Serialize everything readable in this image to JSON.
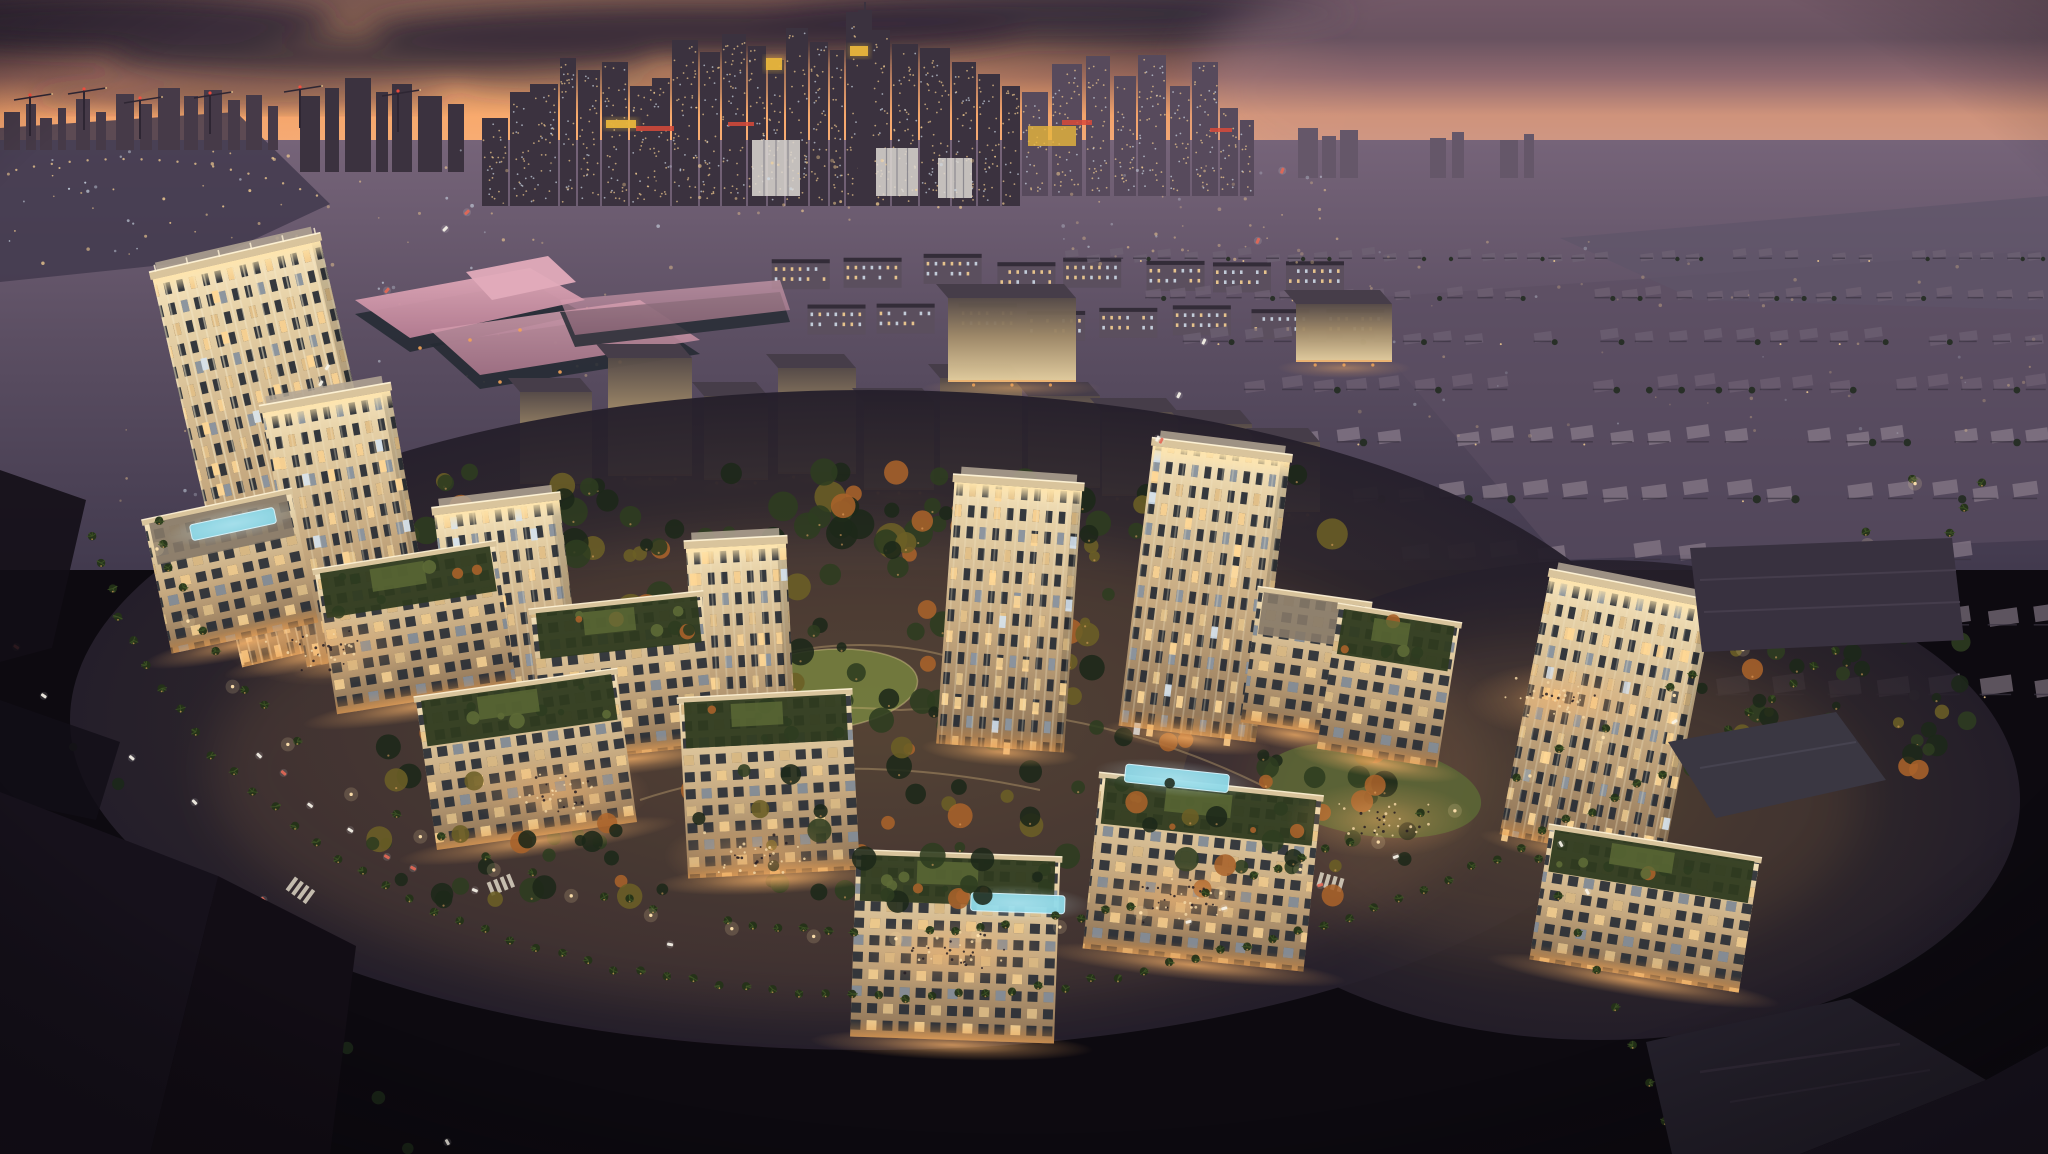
{
  "meta": {
    "description": "Aerial dusk rendering of a palm-lined residential master-planned community: cream mid-rise towers and podium blocks with lit crowns around a central park with lagoon and lawns, ring boulevard with traffic, floodlit campus buildings behind, villa suburbs right, and a high-rise downtown skyline silhouetted against an orange sunset.",
    "time_of_day": "dusk",
    "image_kind": "architectural-rendering"
  },
  "palette": {
    "sky_top": "#443344",
    "cloud_dark": "#342939",
    "sky_dusk": "#7b5254",
    "sky_orange": "#ef9e6a",
    "sky_salmon": "#efa87d",
    "sky_pink": "#d49a8b",
    "sky_lavender": "#aa8691",
    "haze_ground": "#766479",
    "sun_glow": "#ffb26f",
    "plain_mid": "#5c4f63",
    "plain_dark": "#423a4e",
    "sil_near": "#3b323f",
    "sil_mid": "#463a48",
    "sil_far": "#574a5c",
    "sil_haze": "#655769",
    "window_warm": "#ffd795",
    "window_cool": "#d5e2ee",
    "sign_red": "#d84a3a",
    "crown_yellow": "#e7b53c",
    "light_amber": "#f2a357",
    "plaza_glow": "#f7b168",
    "street_glow": "#e9953f",
    "facade_lit": "#f5e3bd",
    "facade_hi": "#e7d2a8",
    "facade_mid": "#c5a87f",
    "facade_shadow": "#8c7154",
    "pier_light": "#f2e5c4",
    "glass_dark": "#262b34",
    "roof_light": "#b3a694",
    "roof_mid": "#857867",
    "parapet": "#d9c49c",
    "crown_glow": "#ffe5ac",
    "campus_dark": "#564b47",
    "campus_mid": "#a08a68",
    "campus_lit": "#e9d3a2",
    "pink_roof": "#b97f95",
    "pink_roof_hi": "#e2abba",
    "pool_aqua": "#82d4e4",
    "pool_rim": "#d8f6ff",
    "pond": "#c5e2de",
    "lawn": "#77823f",
    "lawn_dim": "#5d6a36",
    "tree_dark": "#1c2819",
    "tree_mid": "#2d3c20",
    "tree_warm": "#6b5e26",
    "tree_autumn": "#a8622a",
    "palm": "#243318",
    "asphalt": "#181219",
    "road_warm": "#64452f",
    "ground_core": "#453930",
    "ground_edge": "#251f2b",
    "villa_roof": "#8b7e8c",
    "villa_far": "#6e6173",
    "fg_dark": "#120e16",
    "roof_dark": "#24202b",
    "car_white": "#f7f3e6",
    "car_red": "#e0543f",
    "water": "#5e5468"
  },
  "scene": {
    "skyline": {
      "clusters": [
        {
          "fill": "sil_mid",
          "bottom": 150,
          "bars": [
            [
              4,
              16,
              112
            ],
            [
              26,
              10,
              104
            ],
            [
              40,
              12,
              118
            ],
            [
              58,
              8,
              108
            ],
            [
              76,
              14,
              99
            ],
            [
              96,
              10,
              112
            ],
            [
              116,
              18,
              94
            ],
            [
              140,
              12,
              104
            ],
            [
              158,
              22,
              88
            ],
            [
              184,
              14,
              96
            ],
            [
              204,
              18,
              90
            ],
            [
              228,
              12,
              100
            ],
            [
              246,
              16,
              95
            ],
            [
              268,
              10,
              106
            ]
          ]
        },
        {
          "fill": "sil_near",
          "bottom": 172,
          "bars": [
            [
              300,
              20,
              96
            ],
            [
              325,
              14,
              88
            ],
            [
              345,
              26,
              78
            ],
            [
              376,
              12,
              92
            ],
            [
              392,
              20,
              84
            ],
            [
              418,
              24,
              96
            ],
            [
              448,
              16,
              104
            ]
          ]
        },
        {
          "fill": "sil_near",
          "bottom": 206,
          "windows": true,
          "bars": [
            [
              482,
              26,
              118
            ],
            [
              510,
              20,
              92
            ],
            [
              530,
              28,
              84
            ],
            [
              560,
              16,
              58
            ],
            [
              578,
              22,
              70
            ],
            [
              602,
              26,
              62
            ],
            [
              630,
              22,
              86
            ],
            [
              652,
              18,
              78
            ],
            [
              672,
              26,
              40
            ],
            [
              700,
              20,
              52
            ],
            [
              722,
              24,
              34
            ],
            [
              748,
              18,
              46
            ],
            [
              768,
              16,
              60
            ],
            [
              786,
              22,
              28
            ],
            [
              810,
              18,
              42
            ],
            [
              830,
              14,
              50
            ],
            [
              846,
              24,
              12
            ],
            [
              872,
              18,
              30
            ],
            [
              892,
              26,
              44
            ],
            [
              920,
              30,
              48
            ],
            [
              952,
              24,
              62
            ],
            [
              978,
              22,
              74
            ],
            [
              1002,
              18,
              86
            ]
          ]
        },
        {
          "fill": "sil_far",
          "bottom": 196,
          "windows": true,
          "bars": [
            [
              1022,
              26,
              92
            ],
            [
              1052,
              30,
              64
            ],
            [
              1086,
              24,
              56
            ],
            [
              1114,
              22,
              76
            ],
            [
              1138,
              28,
              55
            ],
            [
              1170,
              20,
              86
            ],
            [
              1192,
              26,
              62
            ],
            [
              1220,
              18,
              108
            ],
            [
              1240,
              14,
              120
            ]
          ]
        },
        {
          "fill": "sil_haze",
          "bottom": 178,
          "bars": [
            [
              1298,
              20,
              128
            ],
            [
              1322,
              14,
              136
            ],
            [
              1340,
              18,
              130
            ],
            [
              1430,
              16,
              138
            ],
            [
              1452,
              12,
              132
            ],
            [
              1500,
              18,
              140
            ],
            [
              1524,
              10,
              134
            ]
          ]
        }
      ],
      "spire": [
        858,
        14,
        10,
        206
      ],
      "lit_crowns": [
        [
          766,
          58,
          16,
          12
        ],
        [
          850,
          46,
          18,
          10
        ],
        [
          606,
          120,
          30,
          8
        ]
      ],
      "lit_base": [
        [
          752,
          140,
          48,
          56
        ],
        [
          876,
          148,
          42,
          48
        ],
        [
          938,
          158,
          34,
          40
        ]
      ],
      "red_signs": [
        [
          636,
          126,
          38,
          5
        ],
        [
          728,
          122,
          26,
          4
        ],
        [
          1062,
          120,
          30,
          5
        ],
        [
          1210,
          128,
          22,
          4
        ]
      ],
      "yellow_slab": [
        1028,
        126,
        48,
        20
      ],
      "cranes": [
        [
          30,
          96
        ],
        [
          84,
          90
        ],
        [
          140,
          99
        ],
        [
          210,
          94
        ],
        [
          300,
          88
        ],
        [
          398,
          92
        ]
      ]
    },
    "campus": [
      [
        520,
        392,
        72,
        92
      ],
      [
        608,
        358,
        84,
        118
      ],
      [
        704,
        396,
        64,
        84
      ],
      [
        778,
        368,
        78,
        106
      ],
      [
        864,
        402,
        70,
        88
      ],
      [
        940,
        378,
        82,
        100
      ],
      [
        1028,
        396,
        72,
        92
      ],
      [
        1102,
        412,
        76,
        84
      ],
      [
        1182,
        424,
        70,
        78
      ],
      [
        1258,
        442,
        62,
        70
      ],
      [
        948,
        298,
        128,
        84
      ],
      [
        1296,
        304,
        96,
        58
      ]
    ],
    "towers": [
      {
        "x": 240,
        "y": 250,
        "w": 172,
        "h": 398,
        "rot": -13,
        "tall": true
      },
      {
        "x": 306,
        "y": 398,
        "w": 130,
        "h": 258,
        "rot": -10
      },
      {
        "x": 462,
        "y": 506,
        "w": 126,
        "h": 232,
        "rot": -7
      },
      {
        "x": 697,
        "y": 546,
        "w": 100,
        "h": 212,
        "rot": -3
      },
      {
        "x": 936,
        "y": 486,
        "w": 128,
        "h": 262,
        "rot": 4
      },
      {
        "x": 1118,
        "y": 452,
        "w": 138,
        "h": 282,
        "rot": 7
      },
      {
        "x": 1498,
        "y": 588,
        "w": 166,
        "h": 262,
        "rot": 11
      }
    ],
    "podiums": [
      {
        "x": 170,
        "y": 506,
        "w": 150,
        "h": 132,
        "rot": -12,
        "pool": [
          44,
          10,
          86,
          16
        ]
      },
      {
        "x": 336,
        "y": 558,
        "w": 182,
        "h": 142,
        "rot": -9,
        "garden": true
      },
      {
        "x": 546,
        "y": 604,
        "w": 172,
        "h": 150,
        "rot": -6,
        "garden": true
      },
      {
        "x": 436,
        "y": 686,
        "w": 202,
        "h": 150,
        "rot": -8,
        "garden": true
      },
      {
        "x": 688,
        "y": 698,
        "w": 172,
        "h": 176,
        "rot": -3,
        "garden": true
      },
      {
        "x": 850,
        "y": 858,
        "w": 204,
        "h": 182,
        "rot": 2,
        "garden": true,
        "pool": [
          116,
          34,
          94,
          18
        ]
      },
      {
        "x": 1082,
        "y": 788,
        "w": 222,
        "h": 172,
        "rot": 6,
        "garden": true,
        "pool": [
          24,
          -16,
          104,
          18
        ]
      },
      {
        "x": 1240,
        "y": 598,
        "w": 112,
        "h": 132,
        "rot": 8
      },
      {
        "x": 1316,
        "y": 616,
        "w": 122,
        "h": 142,
        "rot": 9,
        "garden": true
      },
      {
        "x": 1528,
        "y": 844,
        "w": 212,
        "h": 132,
        "rot": 9,
        "garden": true
      }
    ],
    "generate": {
      "seed": 20481154,
      "scatter": [
        {
          "x": 0,
          "y": 148,
          "w": 300,
          "h": 120,
          "n": 45,
          "o": 0.8
        },
        {
          "x": 300,
          "y": 150,
          "w": 380,
          "h": 240,
          "n": 60,
          "o": 0.6
        },
        {
          "x": 690,
          "y": 150,
          "w": 330,
          "h": 70,
          "n": 36,
          "o": 0.7
        },
        {
          "x": 1040,
          "y": 156,
          "w": 300,
          "h": 110,
          "n": 50,
          "o": 0.5
        },
        {
          "x": 1340,
          "y": 240,
          "w": 700,
          "h": 200,
          "n": 60,
          "o": 0.35
        },
        {
          "x": 120,
          "y": 380,
          "w": 280,
          "h": 220,
          "n": 26,
          "o": 0.5
        }
      ],
      "villas": {
        "x0": 1060,
        "y0": 252,
        "rows": 9,
        "dy": 36,
        "xstep_row": 55,
        "w": 13,
        "h": 7,
        "grow": 1.6,
        "xmax": 2040
      },
      "apartments": {
        "x0": 772,
        "y0": 258,
        "cols": 8,
        "dx": 74,
        "rows": 2,
        "dy": 48,
        "w": 58,
        "h": 30
      },
      "park_trees": {
        "cx": 880,
        "cy": 700,
        "rx": 560,
        "ry": 195,
        "n": 170
      },
      "back_trees": {
        "x": 250,
        "y": 468,
        "w": 1100,
        "h": 88,
        "n": 80
      },
      "right_trees": {
        "x": 1650,
        "y": 620,
        "w": 330,
        "h": 150,
        "n": 40
      },
      "front_trees": {
        "x": 360,
        "y": 770,
        "w": 1060,
        "h": 135,
        "n": 70
      },
      "palms_every": 26,
      "lights_every": 84,
      "cars": {
        "ring": 13,
        "avenue": 7,
        "hw_right": 6,
        "hw_left": 5,
        "exit": 3
      },
      "plazas": [
        [
          556,
          792
        ],
        [
          758,
          856
        ],
        [
          952,
          952
        ],
        [
          1180,
          900
        ],
        [
          320,
          648
        ],
        [
          1380,
          820
        ],
        [
          1560,
          700
        ]
      ],
      "people_per_plaza": 34,
      "skyline_window_density": 0.012
    }
  }
}
